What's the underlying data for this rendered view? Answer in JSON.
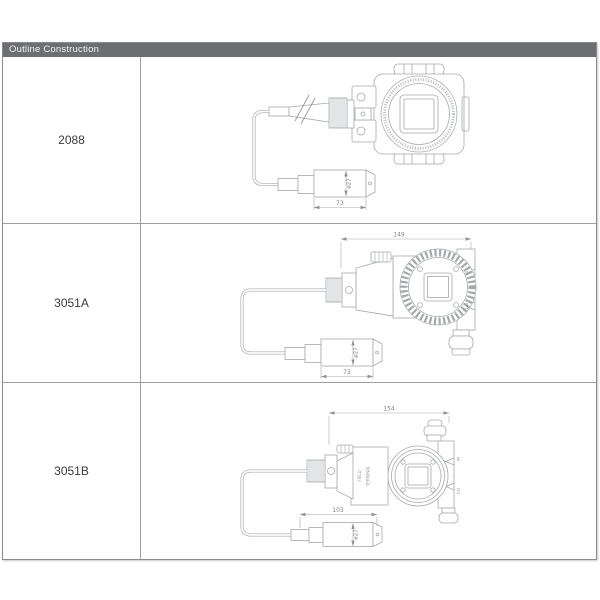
{
  "header": {
    "title": "Outline Construction"
  },
  "rows": [
    {
      "model": "2088",
      "dims": {
        "probe_length": "73",
        "probe_diameter": "ø27"
      }
    },
    {
      "model": "3051A",
      "dims": {
        "overall_width": "149",
        "probe_length": "73",
        "probe_diameter": "ø27",
        "flange_dim_top": "95",
        "flange_dim_bottom": "112"
      }
    },
    {
      "model": "3051B",
      "dims": {
        "overall_width": "154",
        "probe_length": "103",
        "probe_diameter": "ø27",
        "flange_dim_top": "95",
        "flange_dim_bottom": "112"
      },
      "body_text": {
        "line1": "FIELD",
        "line2": "TERMINAL"
      }
    }
  ],
  "colors": {
    "headerbg": "#6d6e71",
    "headerfg": "#f2f2f2",
    "border": "#8a8a8a",
    "grid": "#9c9ea0",
    "line": "#a6a9ac",
    "dimtext": "#7d8084",
    "label": "#3b3b3b"
  }
}
